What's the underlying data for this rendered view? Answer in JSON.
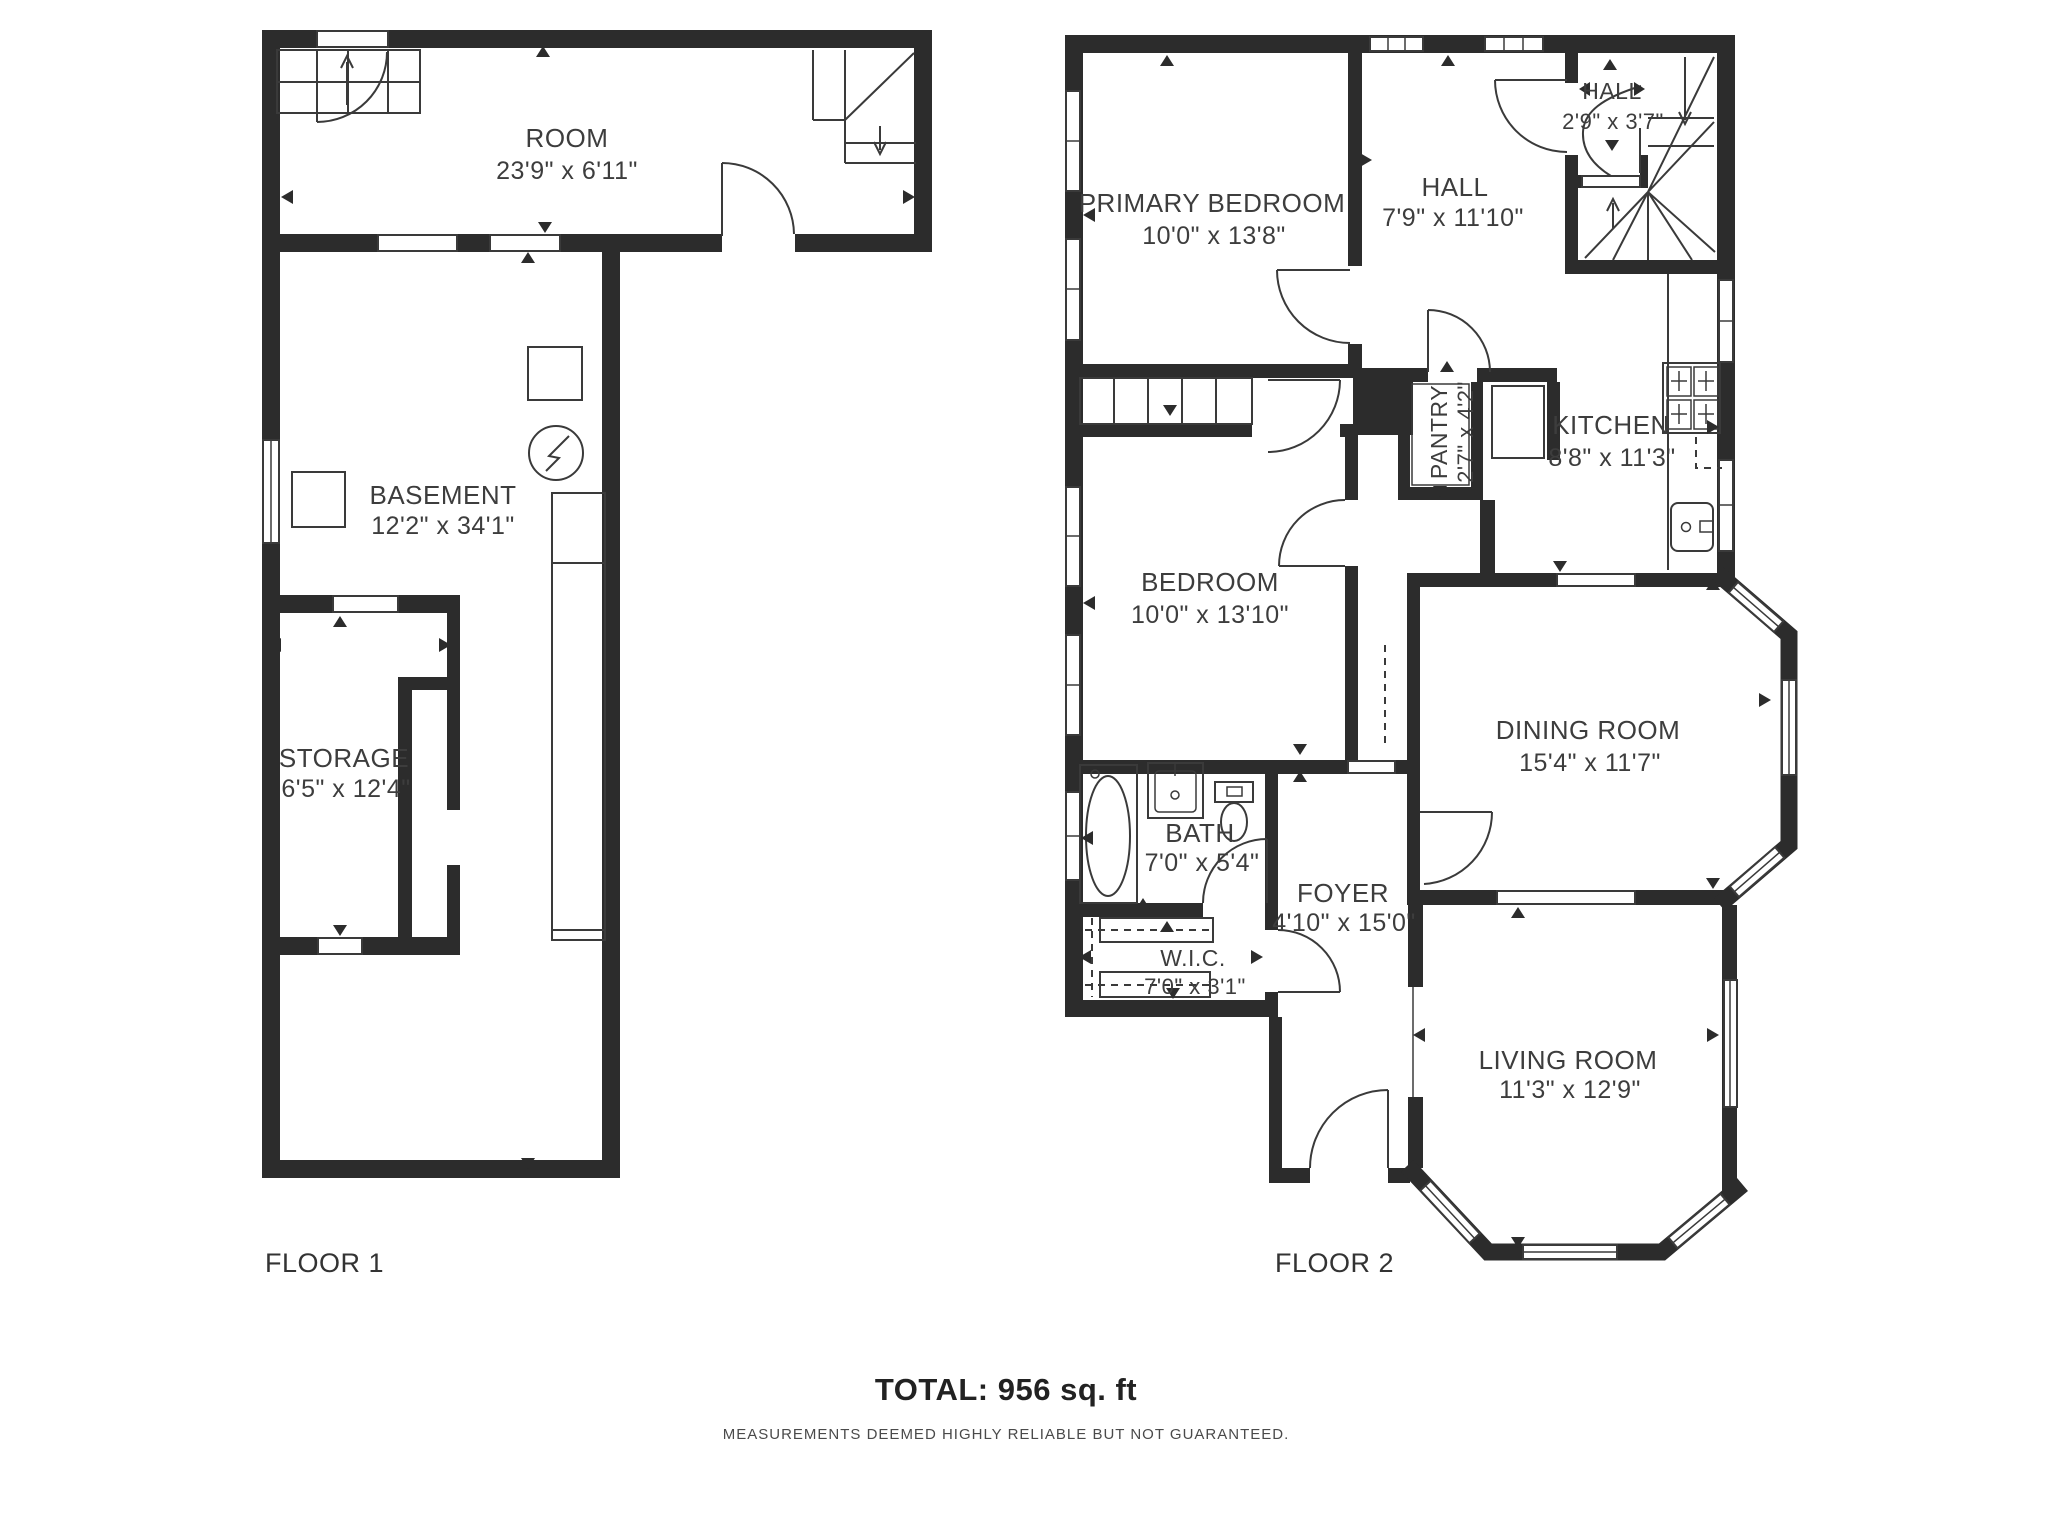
{
  "floor1": {
    "label": "FLOOR 1",
    "rooms": {
      "room": {
        "name": "ROOM",
        "dims": "23'9\" x 6'11\""
      },
      "basement": {
        "name": "BASEMENT",
        "dims": "12'2\" x 34'1\""
      },
      "storage": {
        "name": "STORAGE",
        "dims": "6'5\" x 12'4\""
      }
    }
  },
  "floor2": {
    "label": "FLOOR 2",
    "rooms": {
      "primary_bedroom": {
        "name": "PRIMARY BEDROOM",
        "dims": "10'0\" x 13'8\""
      },
      "hall": {
        "name": "HALL",
        "dims": "7'9\" x 11'10\""
      },
      "hall_small": {
        "name": "HALL",
        "dims": "2'9\" x 3'7\""
      },
      "pantry": {
        "name": "PANTRY",
        "dims": "2'7\" x 4'2\""
      },
      "kitchen": {
        "name": "KITCHEN",
        "dims": "8'8\" x 11'3\""
      },
      "bedroom": {
        "name": "BEDROOM",
        "dims": "10'0\" x 13'10\""
      },
      "dining_room": {
        "name": "DINING ROOM",
        "dims": "15'4\" x 11'7\""
      },
      "bath": {
        "name": "BATH",
        "dims": "7'0\" x 5'4\""
      },
      "foyer": {
        "name": "FOYER",
        "dims": "4'10\" x 15'0\""
      },
      "wic": {
        "name": "W.I.C.",
        "dims": "7'0\" x 3'1\""
      },
      "living_room": {
        "name": "LIVING ROOM",
        "dims": "11'3\" x 12'9\""
      }
    }
  },
  "footer": {
    "total": "TOTAL: 956 sq. ft",
    "disclaimer": "MEASUREMENTS DEEMED HIGHLY RELIABLE BUT NOT GUARANTEED."
  },
  "colors": {
    "wall": "#2c2c2c",
    "line": "#3a3a3a",
    "text": "#3d3d3d"
  }
}
